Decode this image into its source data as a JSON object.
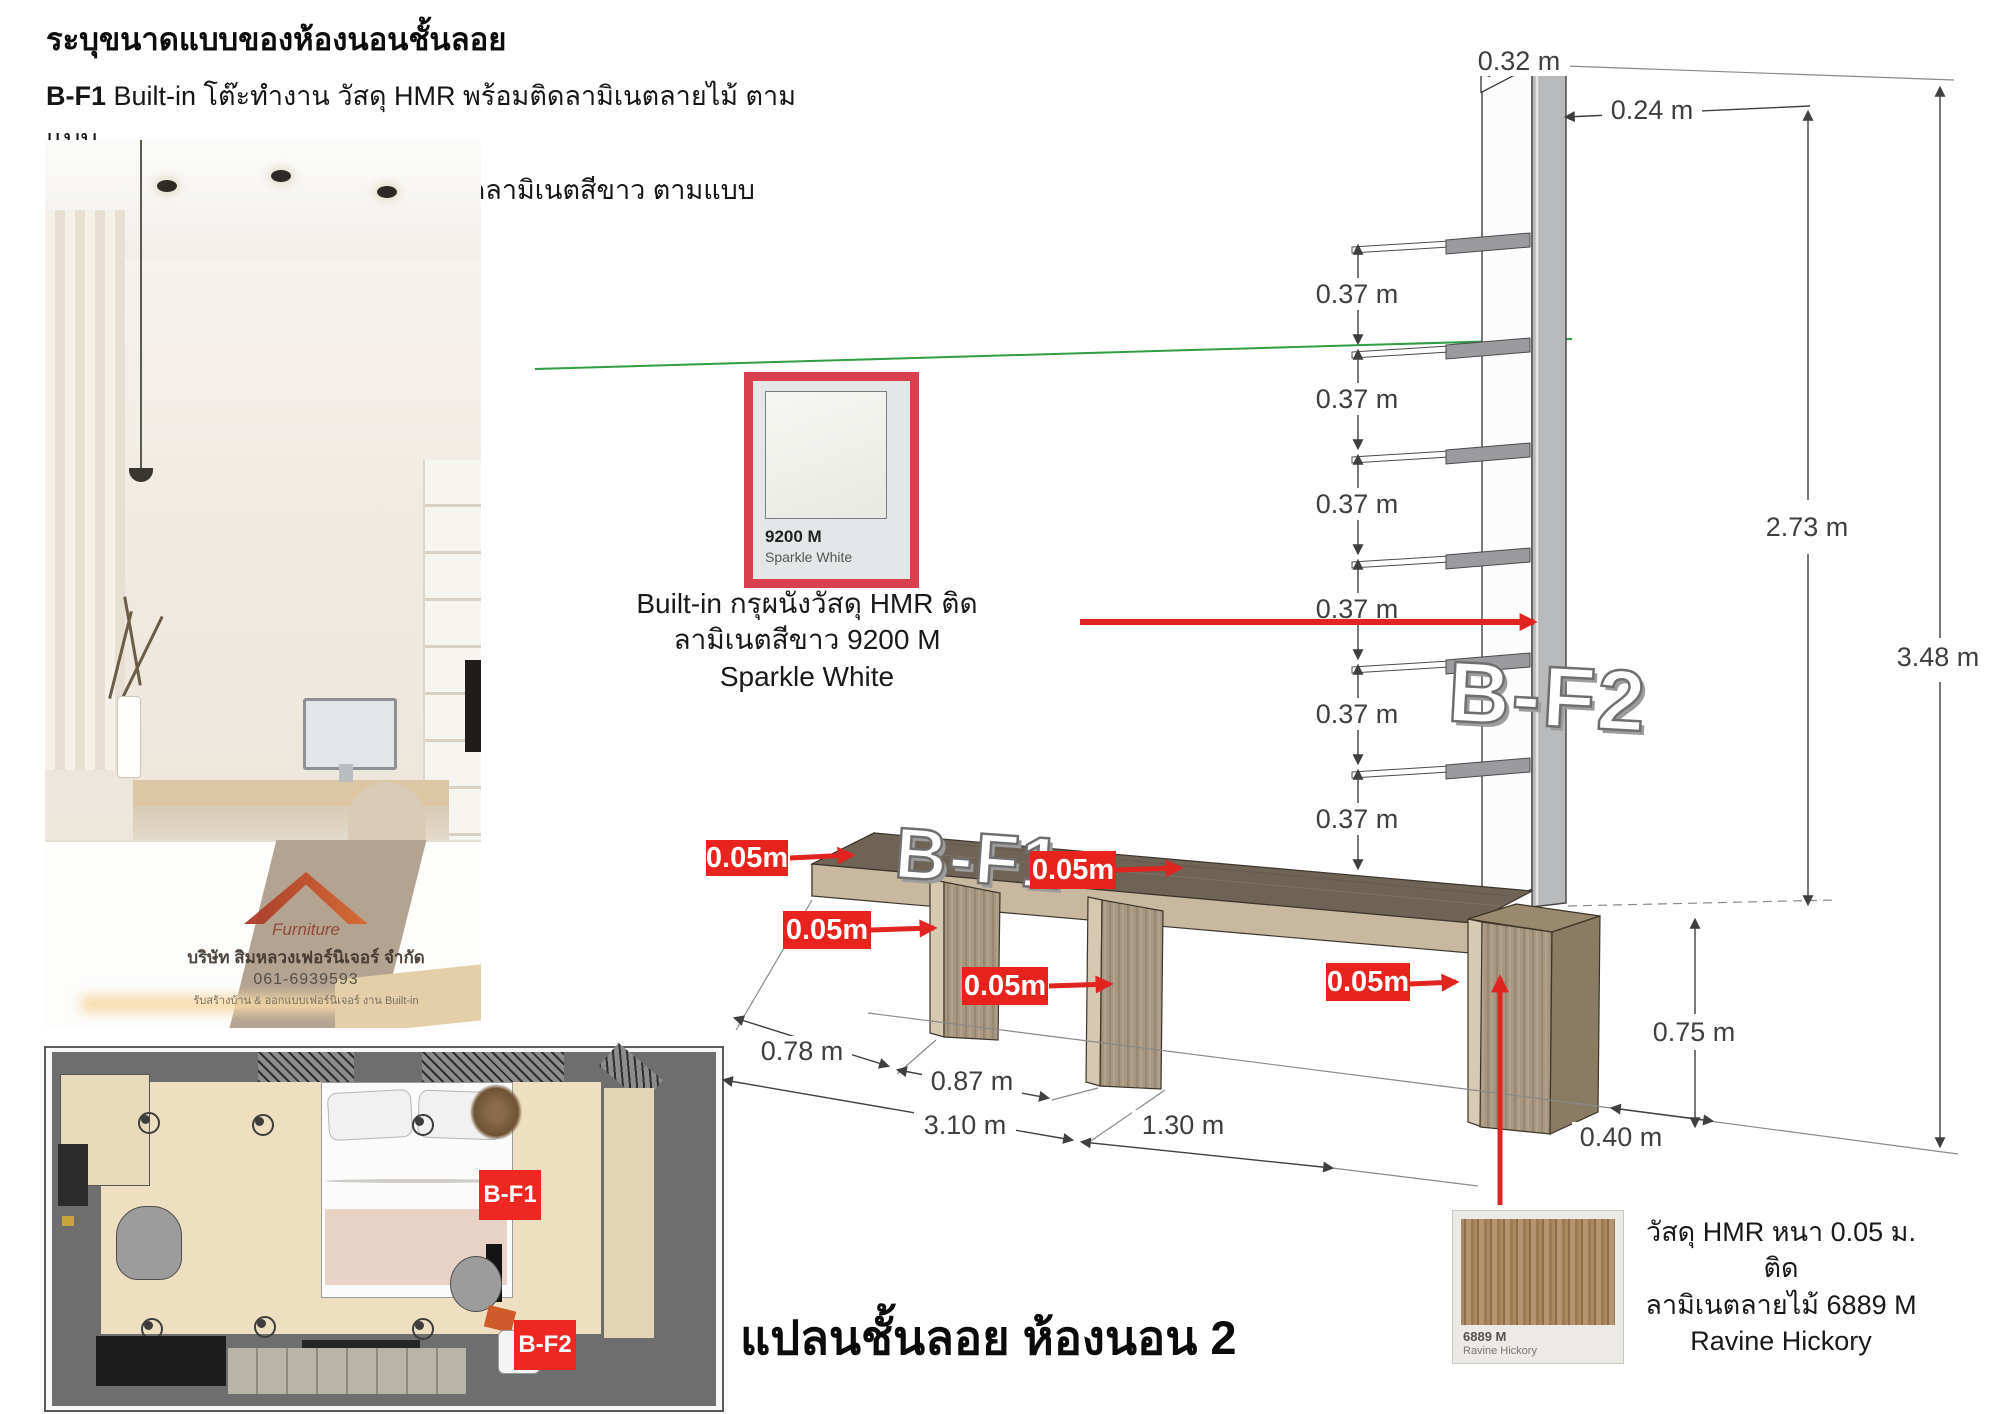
{
  "header": {
    "title": "ระบุขนาดแบบของห้องนอนชั้นลอย",
    "items": [
      {
        "code": "B-F1",
        "desc": "Built-in โต๊ะทำงาน วัสดุ HMR พร้อมติดลามิเนตลายไม้  ตามแบบ"
      },
      {
        "code": "B-F2",
        "desc": "Built-in ตู้สูง วัสดุ HMR พร้อมติดลามิเนตสีขาว ตามแบบ"
      }
    ]
  },
  "photo": {
    "watermark": {
      "brand": "Furniture",
      "company": "บริษัท สิมหลวงเฟอร์นิเจอร์ จำกัด",
      "phone": "061-6939593",
      "tagline": "รับสร้างบ้าน & ออกแบบเฟอร์นิเจอร์ งาน Built-in"
    }
  },
  "floor_plan": {
    "label_bf1": "B-F1",
    "label_bf2": "B-F2"
  },
  "materials": {
    "white_laminate": {
      "code": "9200 M",
      "name": "Sparkle White",
      "note_line1": "Built-in กรุผนังวัสดุ HMR ติด",
      "note_line2": "ลามิเนตสีขาว 9200 M",
      "note_line3": "Sparkle White"
    },
    "wood_laminate": {
      "code": "6889 M",
      "name": "Ravine Hickory",
      "note_line1": "วัสดุ HMR หนา 0.05 ม. ติด",
      "note_line2": "ลามิเนตลายไม้  6889 M",
      "note_line3": "Ravine Hickory"
    }
  },
  "elevation": {
    "unit_labels": {
      "bf1": "B-F1",
      "bf2": "B-F2"
    },
    "thickness_label": "0.05m",
    "dims": {
      "shelf_gap": "0.37 m",
      "top_depth": "0.32 m",
      "panel_offset": "0.24 m",
      "shelf_height": "2.73 m",
      "total_height": "3.48 m",
      "desk_height": "0.75 m",
      "cabinet_depth": "0.40 m",
      "left_run": "0.78 m",
      "mid_run": "0.87 m",
      "desk_width": "3.10 m",
      "right_run": "1.30 m"
    }
  },
  "footer": {
    "title": "แปลนชั้นลอย ห้องนอน 2"
  },
  "colors": {
    "accent_red": "#e8231d",
    "swatch_border": "#d8404e",
    "axis_green": "#2f9e42"
  }
}
